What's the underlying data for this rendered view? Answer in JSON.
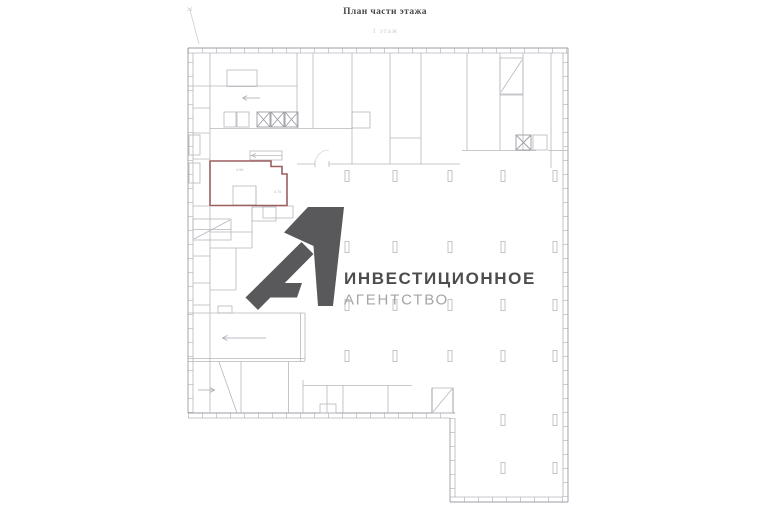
{
  "header": {
    "title": "План части этажа",
    "subtitle": "1 этаж"
  },
  "logo": {
    "line1": "ИНВЕСТИЦИОННОЕ",
    "line2": "АГЕНТСТВО"
  },
  "plan": {
    "highlight_room": {
      "dim1": "4.96",
      "dim2": "4.76"
    }
  },
  "colors": {
    "background": "#ffffff",
    "plan_line": "#b6b6bd",
    "plan_wall": "#9d9da5",
    "highlight_outline": "#9b5f5f",
    "logo_mark": "#59595b",
    "logo_text_primary": "#4d4d4f",
    "logo_text_secondary": "#a5a5a8"
  }
}
